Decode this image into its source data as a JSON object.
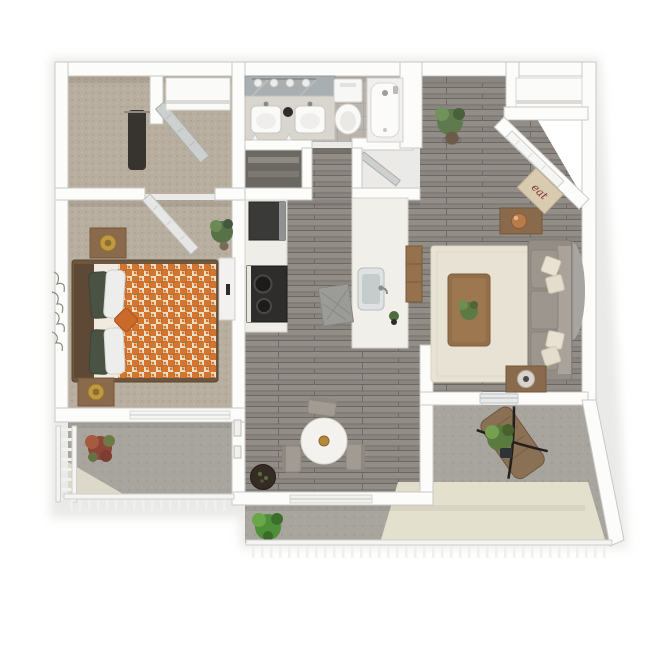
{
  "page": {
    "title": "3D Floor Plan — One Bedroom Apartment"
  },
  "floor_plan": {
    "view": "top-down 3D dollhouse render",
    "layout": "one bedroom, one bathroom, open kitchen and living room, dining nook, two patios",
    "entry_mat": {
      "text": "eat"
    },
    "rooms": [
      {
        "name": "walk-in-closet",
        "flooring": "carpet"
      },
      {
        "name": "hallway",
        "flooring": "carpet"
      },
      {
        "name": "bathroom",
        "flooring": "tile",
        "fixtures": [
          "double-sink vanity",
          "mirror with four-bulb light",
          "toilet",
          "bathtub"
        ]
      },
      {
        "name": "linen-closet",
        "flooring": "shelving"
      },
      {
        "name": "utility-closet",
        "flooring": "vinyl"
      },
      {
        "name": "bedroom",
        "flooring": "carpet",
        "furniture": [
          "queen bed with orange trellis duvet",
          "two nightstands",
          "two gold lamps",
          "white dresser",
          "leaf wall art",
          "potted plant"
        ]
      },
      {
        "name": "kitchen",
        "flooring": "gray wood plank",
        "furniture": [
          "refrigerator",
          "black range cooktop",
          "counter",
          "island with sink",
          "wood cabinet",
          "floor mat"
        ]
      },
      {
        "name": "dining-area",
        "flooring": "gray wood plank",
        "furniture": [
          "round dining table",
          "three gray chairs",
          "dark round planter",
          "two wall frames"
        ]
      },
      {
        "name": "living-room",
        "flooring": "gray wood plank",
        "furniture": [
          "gray sofa with four cream pillows",
          "wood coffee table with plant",
          "console table with copper lamp",
          "end table with lamp",
          "cream area rug",
          "gray oval accent rug"
        ]
      },
      {
        "name": "entry",
        "features": [
          "angled front door",
          "coat closet",
          "script welcome mat"
        ]
      },
      {
        "name": "bedroom-balcony",
        "features": [
          "ladder railing",
          "post railing",
          "red-leaf plant"
        ]
      },
      {
        "name": "patio",
        "features": [
          "post railing",
          "wood lounger with black frame",
          "potted plant",
          "sliding glass door",
          "sunlit concrete"
        ]
      }
    ],
    "palette": {
      "wall": "#fcfcfb",
      "wall_edge": "#c9c9c6",
      "carpet": "#b7ae9f",
      "wood_floor": "#8a8580",
      "concrete": "#a8a59e",
      "sunlit_concrete": "#e9e5d3",
      "duvet_orange": "#d4752e",
      "sofa_gray": "#9d968f",
      "rug_cream": "#e7e2d4",
      "wood_furniture": "#8a6a4c",
      "accent_dark": "#2f2d2b",
      "gold": "#b5883c"
    }
  }
}
